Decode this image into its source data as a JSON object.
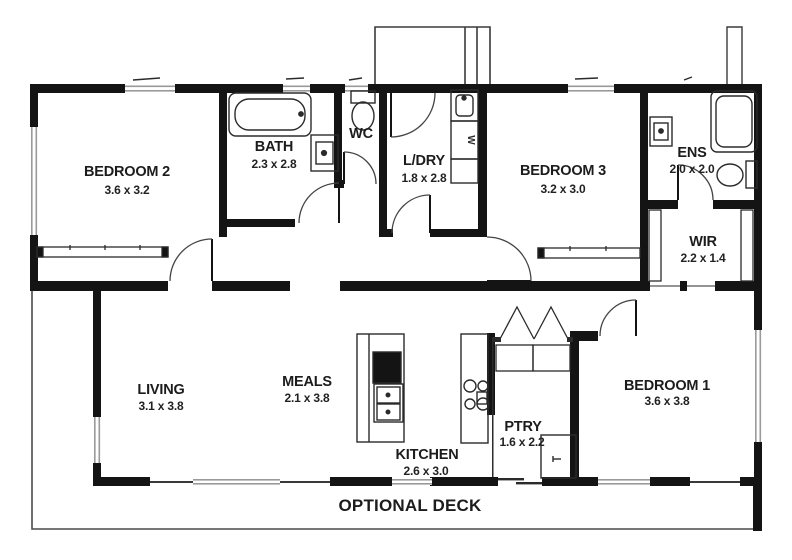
{
  "plan_title": "Single storey house floor plan",
  "rooms": [
    {
      "name": "BEDROOM 2",
      "dims": "3.6 x 3.2"
    },
    {
      "name": "BATH",
      "dims": "2.3 x 2.8"
    },
    {
      "name": "WC",
      "dims": ""
    },
    {
      "name": "L/DRY",
      "dims": "1.8 x 2.8"
    },
    {
      "name": "BEDROOM 3",
      "dims": "3.2 x 3.0"
    },
    {
      "name": "ENS",
      "dims": "2.0 x 2.0"
    },
    {
      "name": "WIR",
      "dims": "2.2 x 1.4"
    },
    {
      "name": "LIVING",
      "dims": "3.1 x 3.8"
    },
    {
      "name": "MEALS",
      "dims": "2.1 x 3.8"
    },
    {
      "name": "KITCHEN",
      "dims": "2.6 x 3.0"
    },
    {
      "name": "PTRY",
      "dims": "1.6 x 2.2"
    },
    {
      "name": "BEDROOM 1",
      "dims": "3.6 x 3.8"
    }
  ],
  "deck": {
    "label": "OPTIONAL DECK"
  },
  "fixtures": {
    "washer_label": "W"
  },
  "colors": {
    "wall": "#141414",
    "window_line": "#9a9a9a",
    "fixture_line": "#2b2b2b",
    "deck_line": "#4a4a4a",
    "text": "#1c1c1c",
    "background": "#ffffff"
  }
}
